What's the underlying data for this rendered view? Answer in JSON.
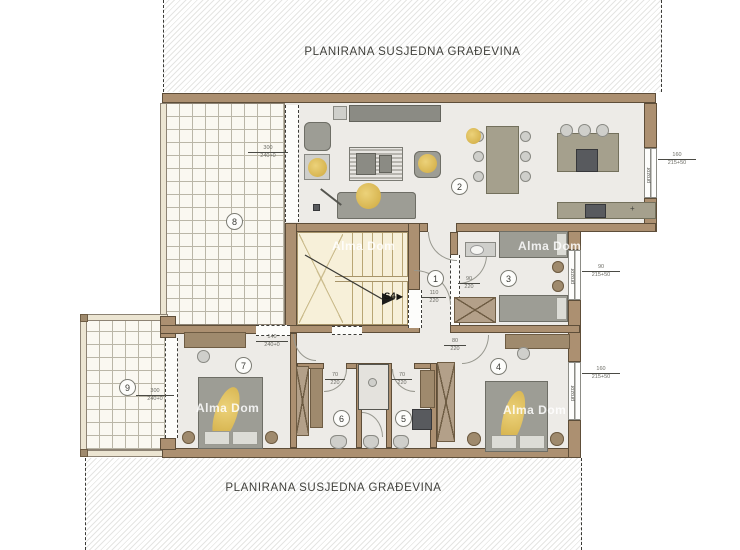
{
  "title_bands": {
    "top": "PLANIRANA SUSJEDNA GRAĐEVINA",
    "bottom": "PLANIRANA SUSJEDNA GRAĐEVINA"
  },
  "watermark_text": "Alma Dom",
  "stair": {
    "label": "S4",
    "arrow": "▶"
  },
  "room_numbers": {
    "hall": "1",
    "living": "2",
    "bedroom_right": "3",
    "bedroom_bottom_right": "4",
    "bath_small": "5",
    "bath_large": "6",
    "bedroom_left": "7",
    "terrace_top": "8",
    "terrace_bottom": "9"
  },
  "window_label": "prozor",
  "symbols": {
    "plus": "+"
  },
  "dims": {
    "terrace8_door": {
      "w": "300",
      "h": "240+0"
    },
    "terrace9_door": {
      "w": "300",
      "h": "240+0"
    },
    "room7_window": {
      "w": "140",
      "h": "240+0"
    },
    "kitchen_window": {
      "w": "160",
      "h": "215+50"
    },
    "room3_window": {
      "w": "90",
      "h": "215+50"
    },
    "room4_window": {
      "w": "160",
      "h": "215+50"
    },
    "entry_door": {
      "w": "110",
      "h": "220"
    },
    "room3_door": {
      "w": "90",
      "h": "220"
    },
    "room4_door": {
      "w": "80",
      "h": "220"
    },
    "bath6_door": {
      "w": "70",
      "h": "220"
    },
    "bath5_door": {
      "w": "70",
      "h": "220"
    }
  },
  "colors": {
    "wall": "#ac9071",
    "floor": "#edebe7",
    "terrace_tile": "#faf8f1",
    "stairwell": "#f7f0d9",
    "furniture_gray": "#9d9d95",
    "plant_yellow": "#dfc269",
    "hatch_line": "#e5e5e3"
  }
}
